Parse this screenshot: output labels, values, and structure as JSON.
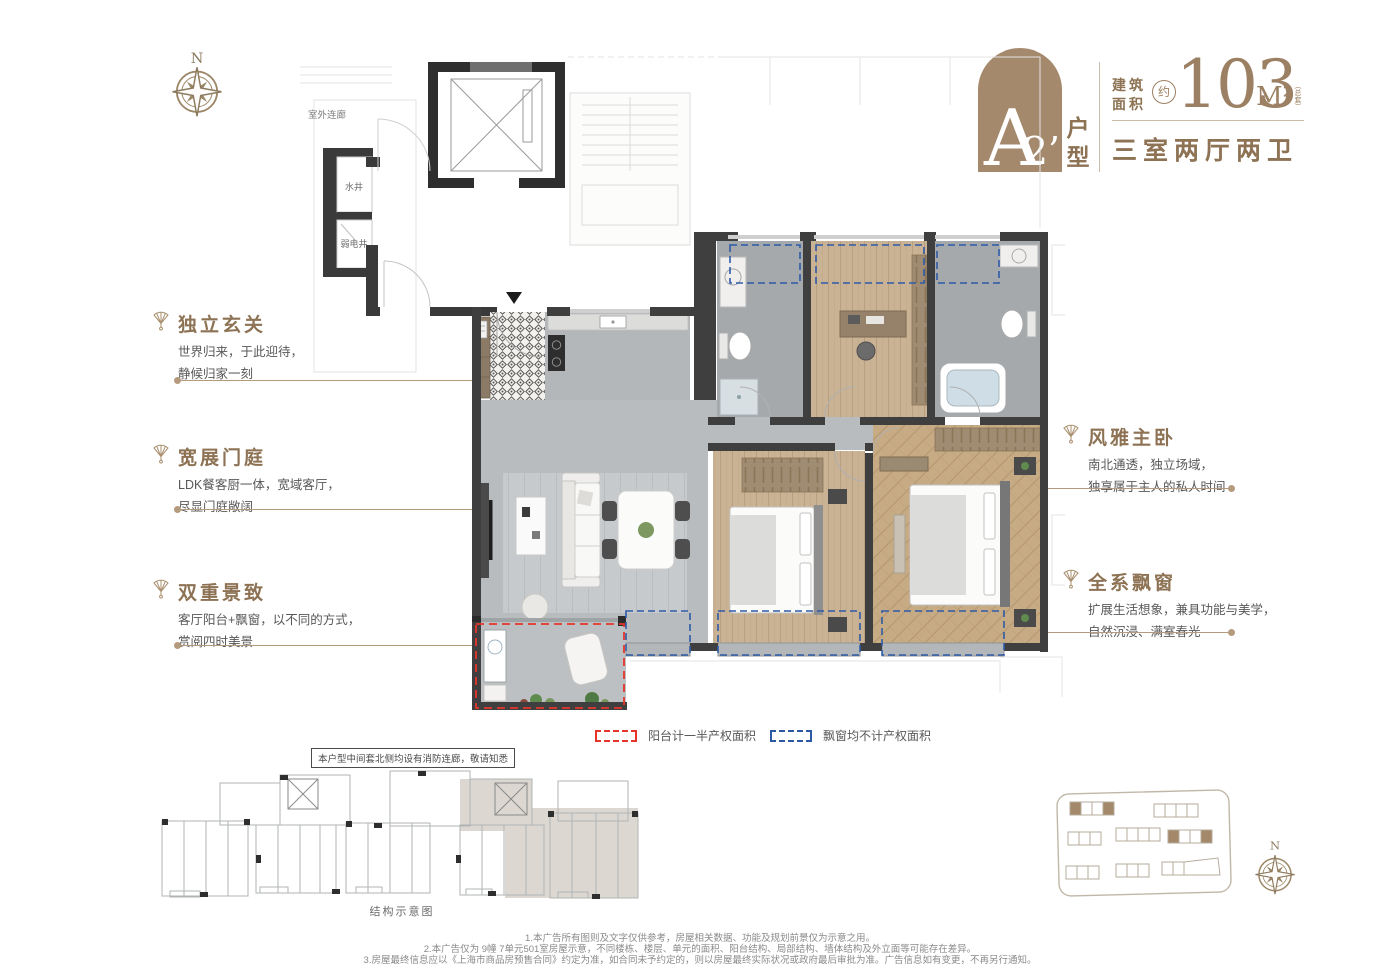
{
  "colors": {
    "accent": "#a5896d",
    "title_brown": "#8d7254",
    "body_gray": "#595757",
    "legend_red": "#e5352b",
    "legend_blue": "#2c59a5",
    "wall_dark": "#3f3f3f"
  },
  "header": {
    "unit_letter": "A",
    "unit_number": "2’",
    "unit_suffix": "户型",
    "area_label_line1": "建筑",
    "area_label_line2": "面积",
    "approx": "约",
    "area_value": "103",
    "area_unit": "M²",
    "area_note": "（总套）",
    "layout_desc": "三室两厅两卫"
  },
  "annotations": {
    "left": [
      {
        "title": "独立玄关",
        "line1": "世界归来，于此迎待，",
        "line2": "静候归家一刻"
      },
      {
        "title": "宽展门庭",
        "line1": "LDK餐客厨一体，宽域客厅，",
        "line2": "尽显门庭敞阔"
      },
      {
        "title": "双重景致",
        "line1": "客厅阳台+飘窗，以不同的方式，",
        "line2": "赏阅四时美景"
      }
    ],
    "right": [
      {
        "title": "风雅主卧",
        "line1": "南北通透，独立场域，",
        "line2": "独享属于主人的私人时间"
      },
      {
        "title": "全系飘窗",
        "line1": "扩展生活想象，兼具功能与美学，",
        "line2": "自然沉浸、满室春光"
      }
    ]
  },
  "floorplan": {
    "outdoor_corridor": "室外连廊",
    "water_shaft": "水井",
    "elec_shaft": "弱电井"
  },
  "legend": {
    "items": [
      {
        "label": "阳台计一半产权面积"
      },
      {
        "label": "飘窗均不计产权面积"
      }
    ]
  },
  "note_box": "本户型中间套北侧均设有消防连廊，敬请知悉",
  "structure": {
    "caption": "结构示意图"
  },
  "compass": {
    "north": "N"
  },
  "disclaimer": {
    "line1": "1.本广告所有图则及文字仅供参考，房屋相关数据、功能及规划前景仅为示意之用。",
    "line2": "2.本广告仅为 9幢 7单元501室房屋示意，不同楼栋、楼层、单元的面积、阳台结构、局部结构、墙体结构及外立面等可能存在差异。",
    "line3": "3.房屋最终信息应以《上海市商品房预售合同》约定为准，如合同未予约定的，则以房屋最终实际状况或政府最后审批为准。广告信息如有变更，不再另行通知。"
  }
}
